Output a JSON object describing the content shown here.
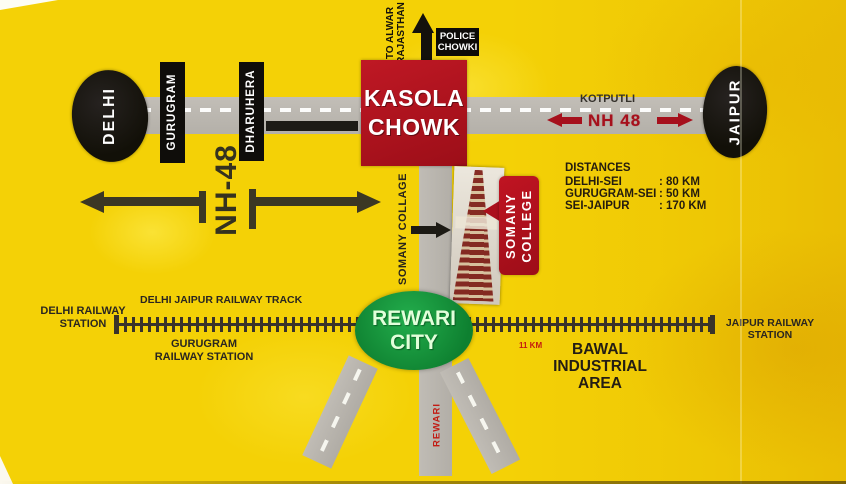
{
  "colors": {
    "background_yellow": "#f4d106",
    "road_gray": "#b9b5ae",
    "brand_red": "#b01421",
    "city_green": "#12963b",
    "label_black": "#141210",
    "nh48_red": "#a6101c"
  },
  "top_area": {
    "to_alwar_line1": "TO ALWAR",
    "to_alwar_line2": "RAJASTHAN",
    "police_line1": "POLICE",
    "police_line2": "CHOWKI",
    "kasola_line1": "KASOLA",
    "kasola_line2": "CHOWK"
  },
  "highway": {
    "delhi": "DELHI",
    "gurugram": "GURUGRAM",
    "dharuhera": "DHARUHERA",
    "nh48_vertical": "NH-48",
    "kotputli": "KOTPUTLI",
    "nh48_shield": "NH 48",
    "jaipur": "JAIPUR"
  },
  "college": {
    "road_label": "SOMANY COLLAGE",
    "callout_line1": "SOMANY",
    "callout_line2": "COLLEGE"
  },
  "distances": {
    "heading": "DISTANCES",
    "rows": [
      {
        "label": "DELHI-SEI",
        "value": ": 80 KM"
      },
      {
        "label": "GURUGRAM-SEI",
        "value": ": 50 KM"
      },
      {
        "label": "SEI-JAIPUR",
        "value": ": 170 KM"
      }
    ]
  },
  "railway": {
    "track_label": "DELHI JAIPUR RAILWAY TRACK",
    "delhi_station_line1": "DELHI RAILWAY",
    "delhi_station_line2": "STATION",
    "gurugram_station_line1": "GURUGRAM",
    "gurugram_station_line2": "RAILWAY STATION",
    "jaipur_station_line1": "JAIPUR RAILWAY",
    "jaipur_station_line2": "STATION",
    "distance_11km": "11 KM"
  },
  "south": {
    "rewari_city_line1": "REWARI",
    "rewari_city_line2": "CITY",
    "rewari_road_label": "REWARI",
    "bawal_line1": "BAWAL",
    "bawal_line2": "INDUSTRIAL",
    "bawal_line3": "AREA"
  }
}
